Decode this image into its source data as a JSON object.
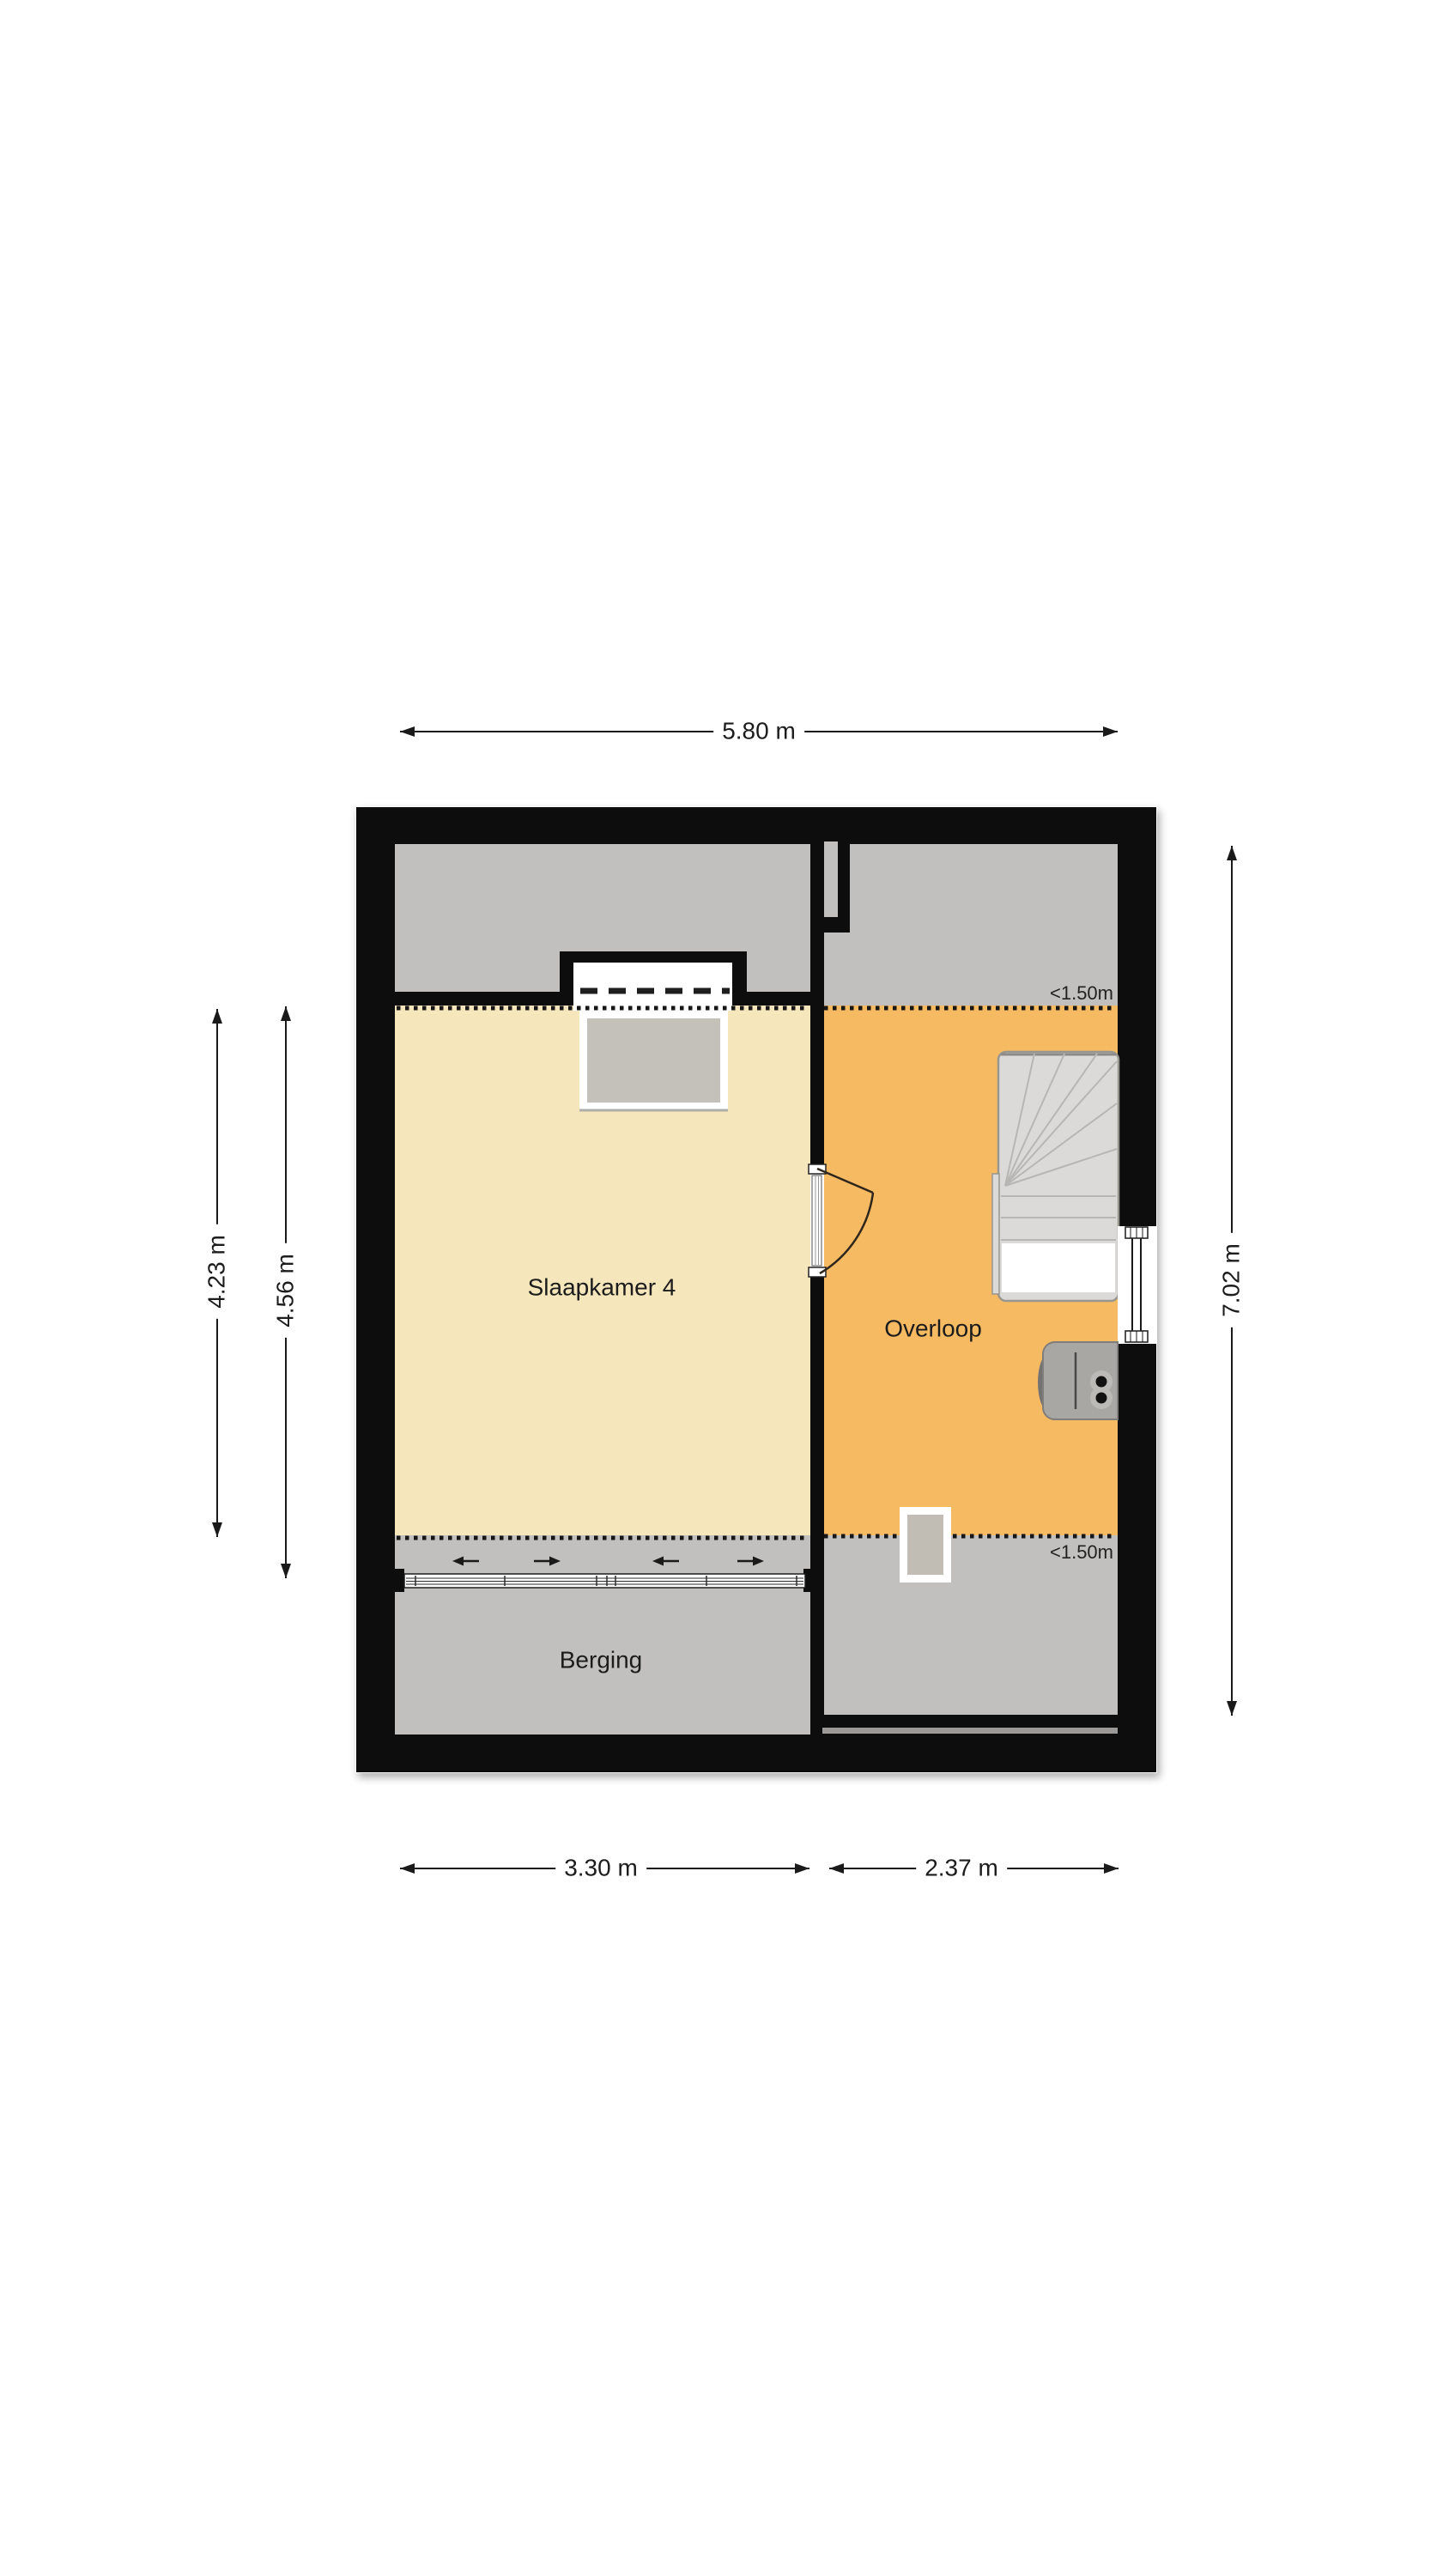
{
  "plan_title": "Floor plan (attic storey)",
  "rooms": {
    "slaapkamer": "Slaapkamer 4",
    "overloop": "Overloop",
    "berging": "Berging"
  },
  "height_markers": {
    "top": "<1.50m",
    "bottom": "<1.50m"
  },
  "dimensions": {
    "width_total": "5.80 m",
    "left_outer": "4.23 m",
    "left_inner": "4.56 m",
    "height_total": "7.02 m",
    "bottom_left": "3.30 m",
    "bottom_right": "2.37 m"
  },
  "colors": {
    "wall": "#0d0d0d",
    "room_yellow": "#f6e6bb",
    "room_orange": "#f6ba63",
    "floor_gray": "#c1c0be",
    "stairs": "#dbdad8",
    "background": "#ffffff"
  }
}
